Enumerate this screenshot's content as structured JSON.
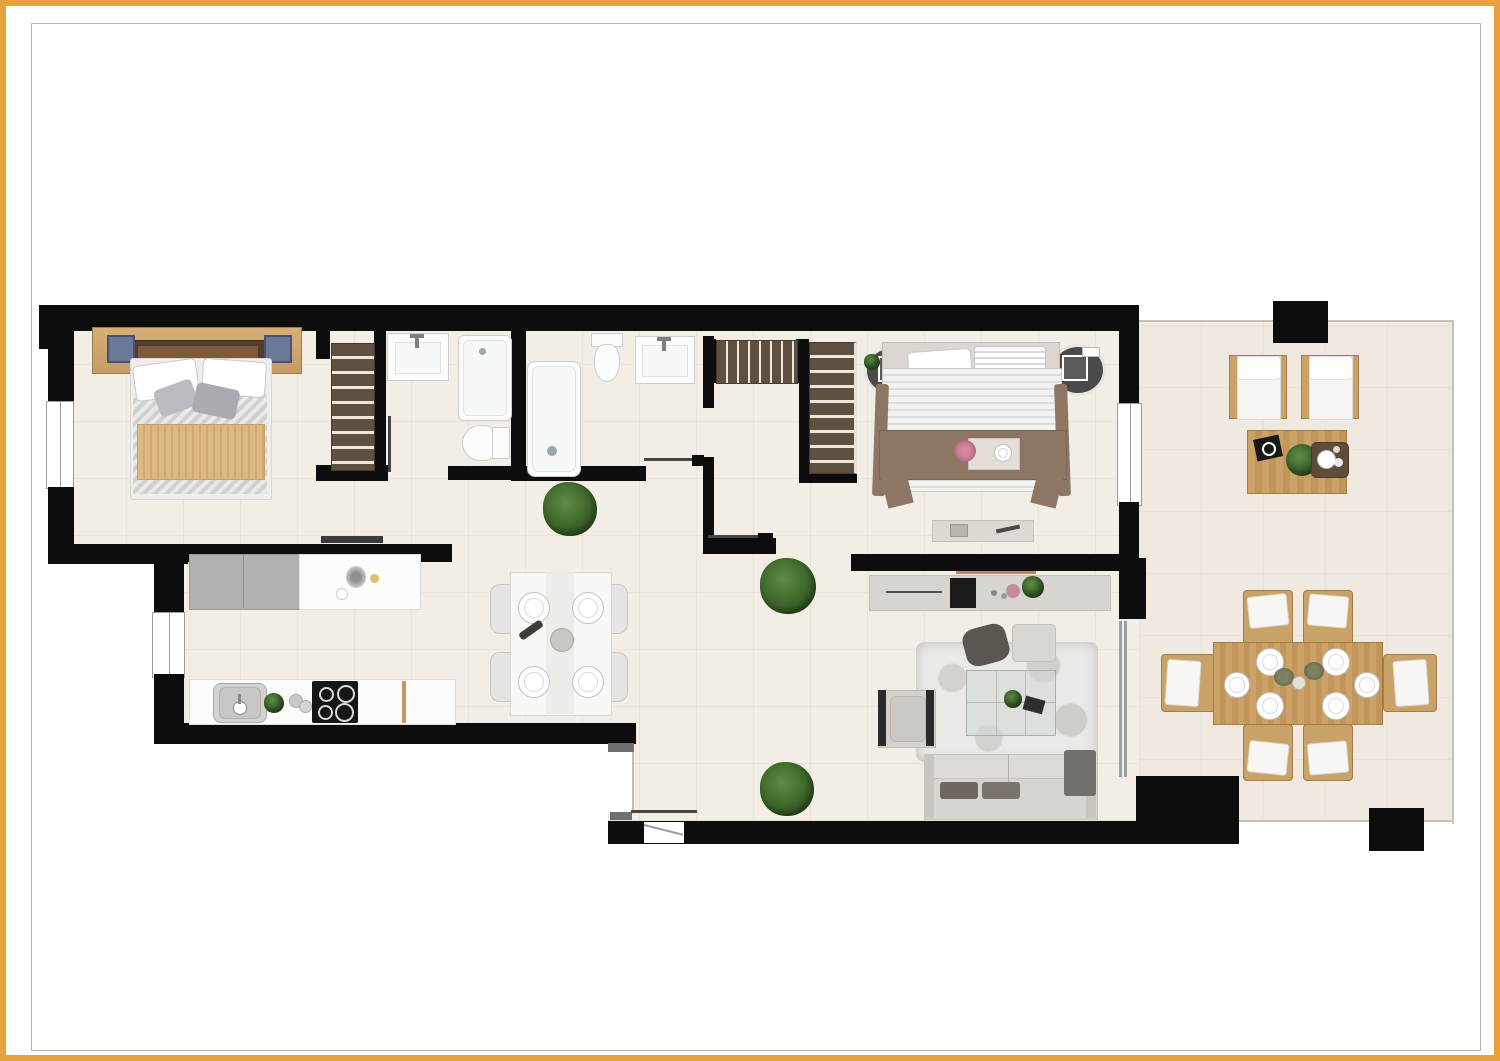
{
  "document": {
    "kind": "apartment floor plan rendering",
    "view": "top-down 2D color render",
    "visible_text": "none"
  },
  "colors": {
    "accent": "#E8A23B",
    "frameline": "#b3b3b3",
    "wall": "#0d0d0d",
    "floor": "#f2ede5",
    "terrace": "#f0e9e0",
    "boundary": "#c6c1b9",
    "wood": "#c9a268",
    "wooddark": "#a47c46",
    "cab": "#5e5142",
    "cabslat": "#efe9dd",
    "whitefurn": "#fcfcfb",
    "fixture": "#c9ced3",
    "graycab": "#b1b1b1",
    "sofa": "#d8d4cf",
    "sofadark": "#6e6760",
    "rug": "#ebe9e6",
    "plantgreen": "#3c6429",
    "tan": "#dcba82",
    "blanketbrown": "#8d7764",
    "headboard": "#503c28",
    "glass": "#ccd6cf",
    "doorline": "#454545"
  },
  "plan": {
    "rooms": [
      {
        "id": "master-bedroom",
        "furniture": [
          "double-bed",
          "headboard-shelf",
          "nightstand-left",
          "nightstand-right",
          "built-in-wardrobe"
        ]
      },
      {
        "id": "bathroom-1",
        "furniture": [
          "washbasin",
          "bathtub",
          "toilet"
        ]
      },
      {
        "id": "bathroom-2",
        "furniture": [
          "shower",
          "toilet",
          "washbasin"
        ]
      },
      {
        "id": "hallway",
        "furniture": [
          "slatted-closet",
          "plant"
        ]
      },
      {
        "id": "bedroom-2",
        "furniture": [
          "double-bed",
          "round-nightstand-left",
          "round-nightstand-right",
          "wardrobe",
          "bench"
        ]
      },
      {
        "id": "kitchen",
        "furniture": [
          "tall-gray-cabinets",
          "white-counter",
          "sink",
          "cooktop-4-burners",
          "plant"
        ]
      },
      {
        "id": "dining-area",
        "furniture": [
          "white-table",
          "chairs-4",
          "place-settings-4",
          "wine-bottle",
          "centerpiece"
        ]
      },
      {
        "id": "living-room",
        "furniture": [
          "tv-sideboard",
          "tv",
          "area-rug",
          "glass-coffee-table",
          "armchair",
          "pouf",
          "throw",
          "sofa",
          "plants"
        ]
      },
      {
        "id": "entrance",
        "furniture": [
          "entry-door-swing"
        ]
      },
      {
        "id": "terrace",
        "furniture": [
          "lounge-chair-2",
          "wood-coffee-table",
          "outdoor-dining-table",
          "outdoor-chairs-6",
          "place-settings-6",
          "pillar-2"
        ]
      }
    ],
    "openings": [
      "window-master-bedroom-left",
      "window-kitchen-left",
      "window-bedroom2-right",
      "sliding-door-terrace",
      "entrance-door-bottom"
    ]
  }
}
